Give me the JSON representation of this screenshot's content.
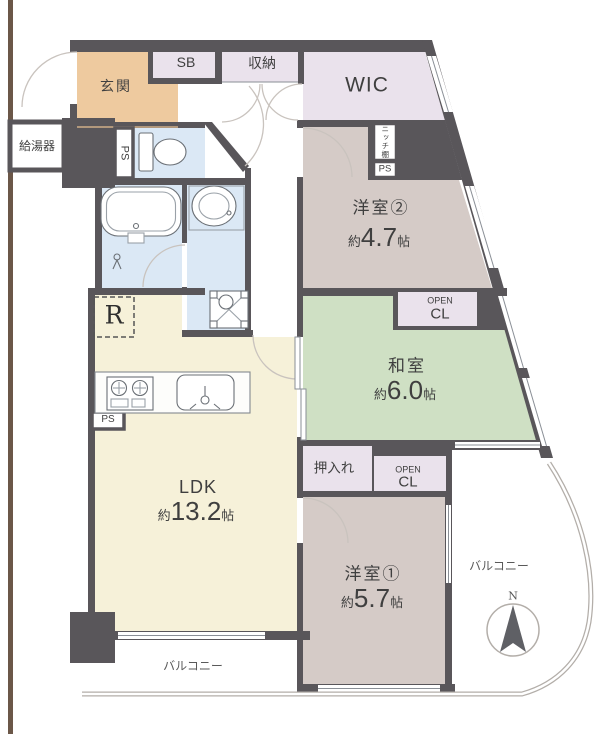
{
  "colors": {
    "wall": "#59565a",
    "beige": "#eeca9f",
    "lavender": "#eae2ec",
    "taupe": "#d5cbc7",
    "green": "#cfe0c4",
    "cream": "#f6f1d9",
    "blue": "#dbe8f5",
    "line": "#8a8f96",
    "arc": "#c9c3be",
    "fixture": "#6b7076",
    "railing": "#b3aea9",
    "brown": "#6b5748",
    "text": "#3f3f3f"
  },
  "plan": {
    "entrance": {
      "label": "玄関"
    },
    "shoe_box": {
      "label": "SB"
    },
    "storage": {
      "label": "収納"
    },
    "wic": {
      "label": "WIC"
    },
    "niche_shelf": {
      "label": "ニッチ棚"
    },
    "pipe_space_niche": {
      "label": "PS"
    },
    "pipe_space_left": {
      "label": "PS"
    },
    "pipe_space_kitchen": {
      "label": "PS"
    },
    "water_heater": {
      "label": "給湯器"
    },
    "western_room_2": {
      "name": "洋室②",
      "approx": "約",
      "value": "4.7",
      "unit": "帖"
    },
    "japanese_room": {
      "name": "和室",
      "approx": "約",
      "value": "6.0",
      "unit": "帖"
    },
    "ldk": {
      "name": "LDK",
      "approx": "約",
      "value": "13.2",
      "unit": "帖"
    },
    "western_room_1": {
      "name": "洋室①",
      "approx": "約",
      "value": "5.7",
      "unit": "帖"
    },
    "closet_oshiire": {
      "label": "押入れ"
    },
    "open_closet_upper": {
      "line1": "OPEN",
      "line2": "CL"
    },
    "open_closet_lower": {
      "line1": "OPEN",
      "line2": "CL"
    },
    "balcony_right": {
      "label": "バルコニー"
    },
    "balcony_bottom": {
      "label": "バルコニー"
    },
    "refrigerator_space": {
      "label": "R"
    },
    "compass_north": {
      "label": "N"
    }
  }
}
